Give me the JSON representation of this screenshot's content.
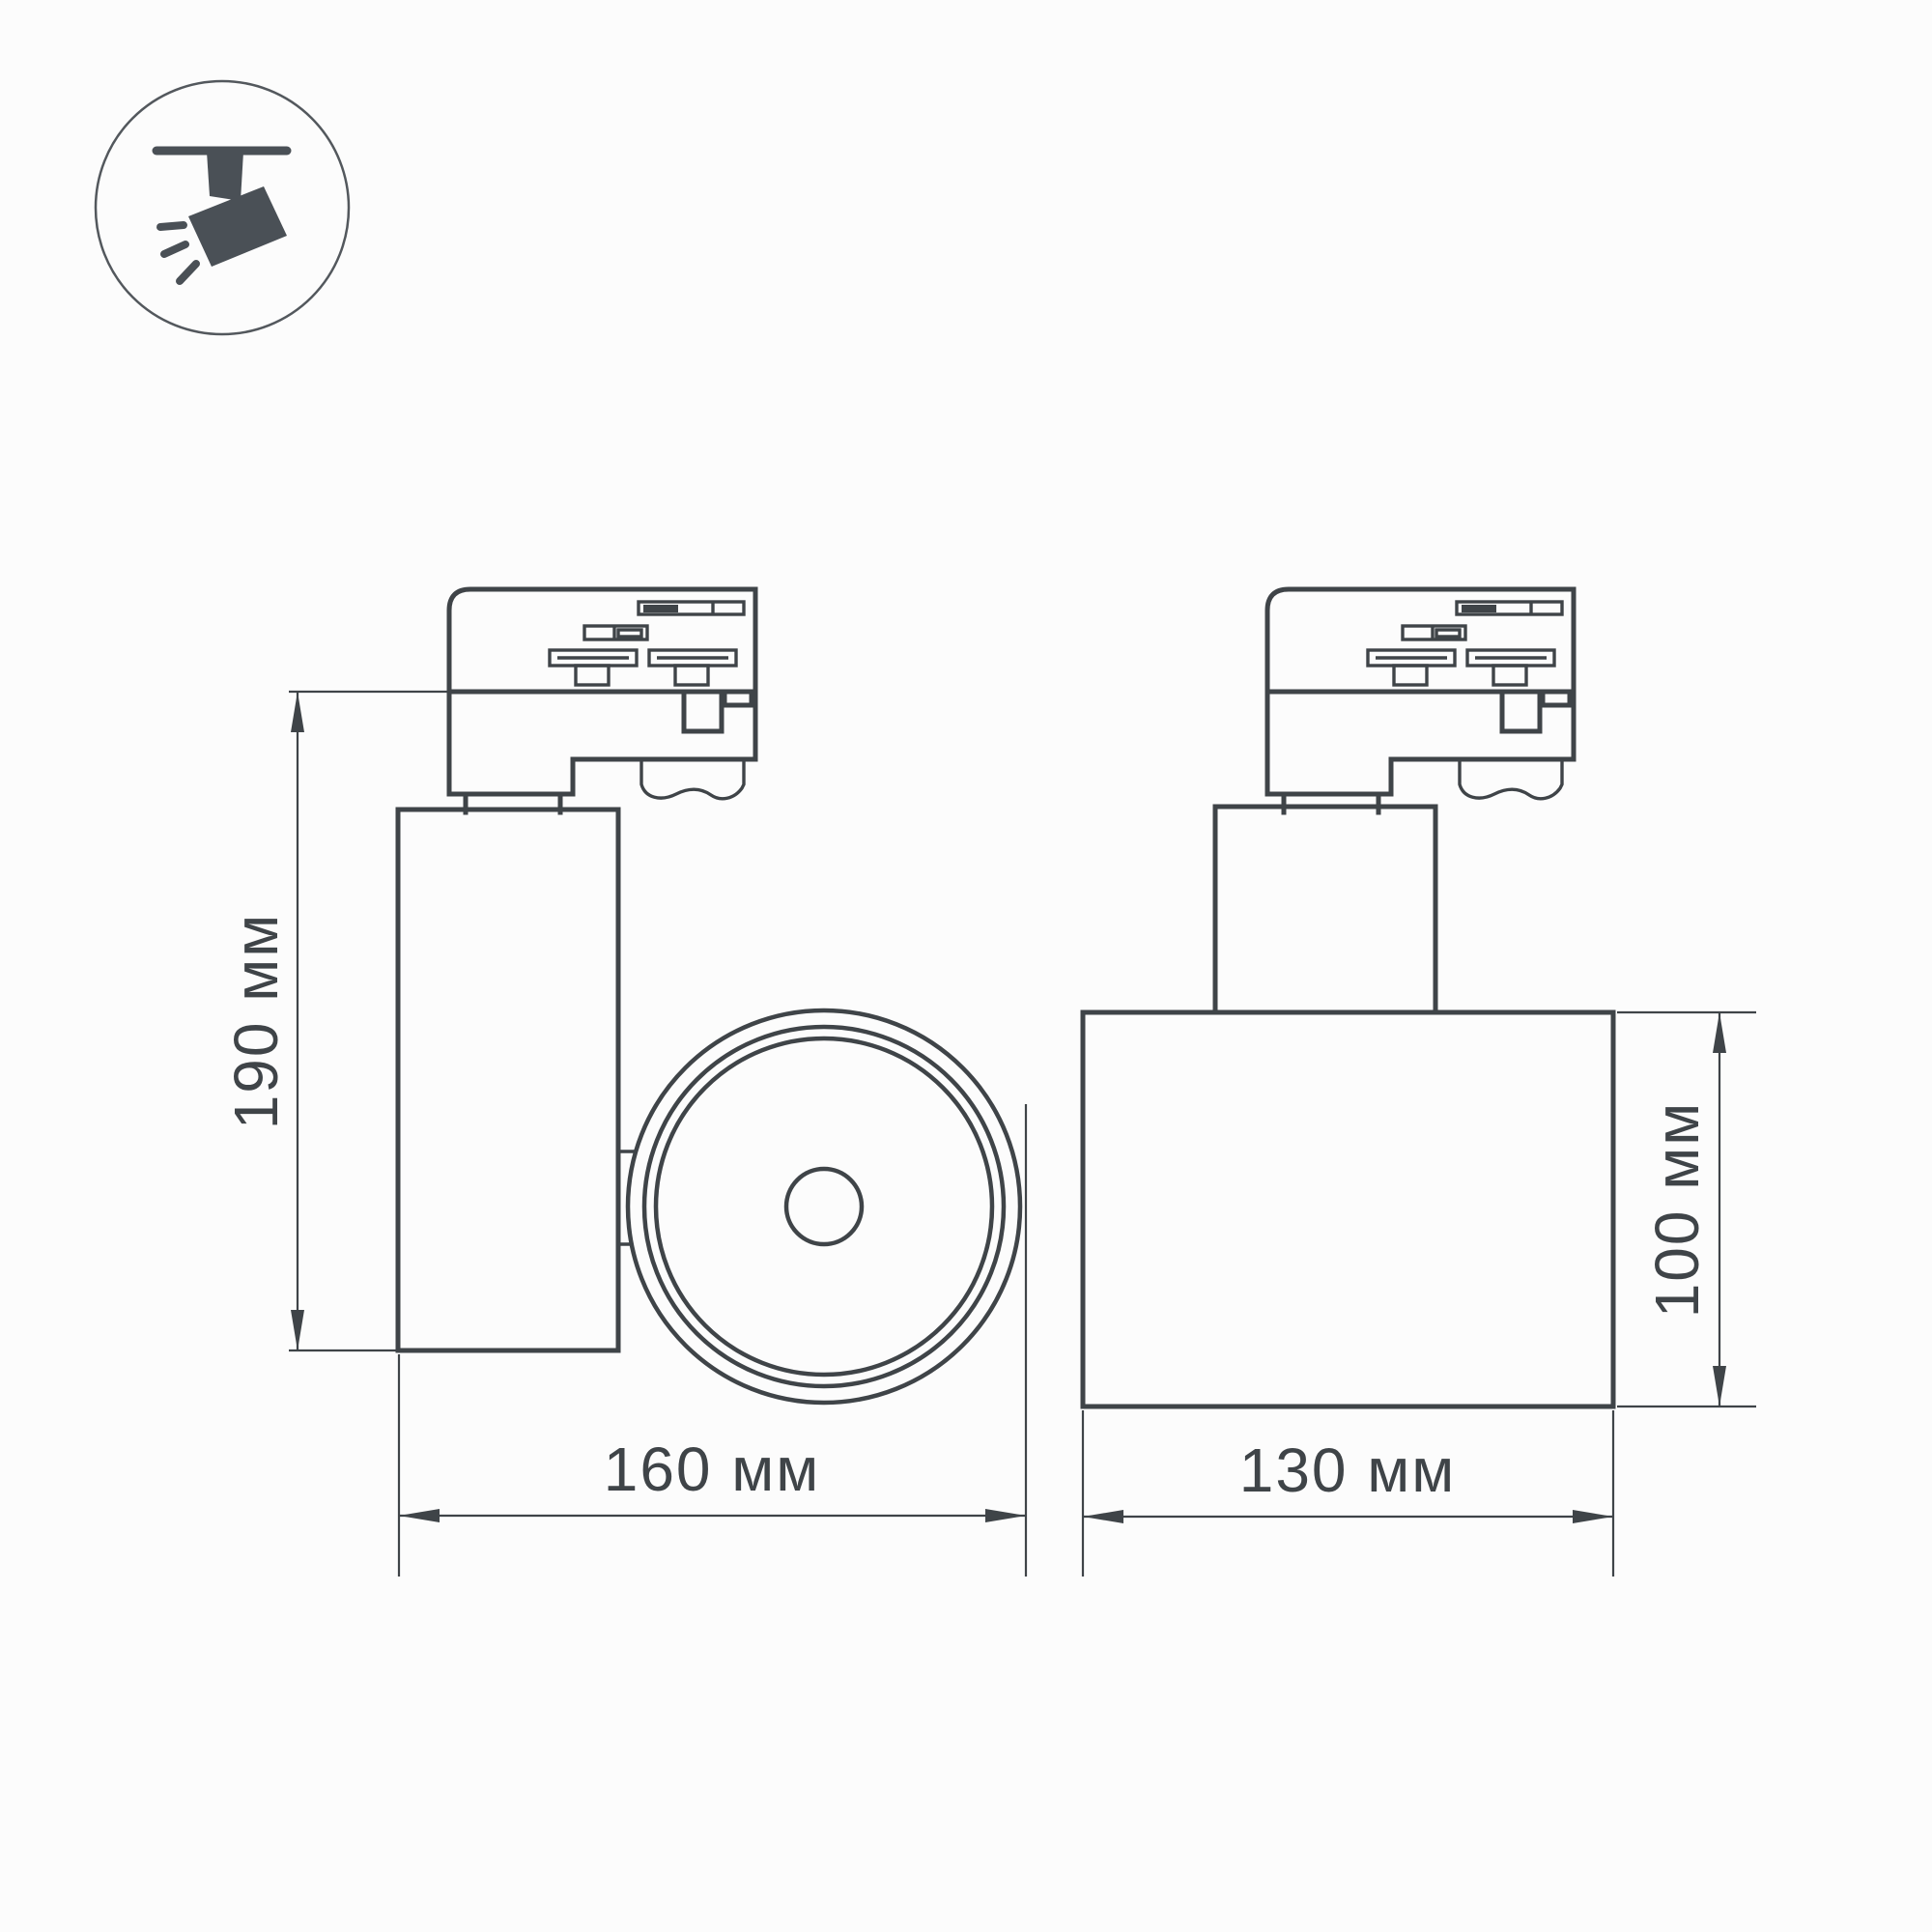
{
  "colors": {
    "background": "#fcfcfc",
    "line": "#3f4448",
    "icon": "#4a5056",
    "icon_ring": "#53585d"
  },
  "icon": {
    "name": "track-spotlight-icon"
  },
  "dimensions": {
    "height": {
      "label": "190 мм",
      "value_mm": 190
    },
    "width": {
      "label": "160 мм",
      "value_mm": 160
    },
    "depth": {
      "label": "130 мм",
      "value_mm": 130
    },
    "body_height": {
      "label": "100 мм",
      "value_mm": 100
    }
  }
}
